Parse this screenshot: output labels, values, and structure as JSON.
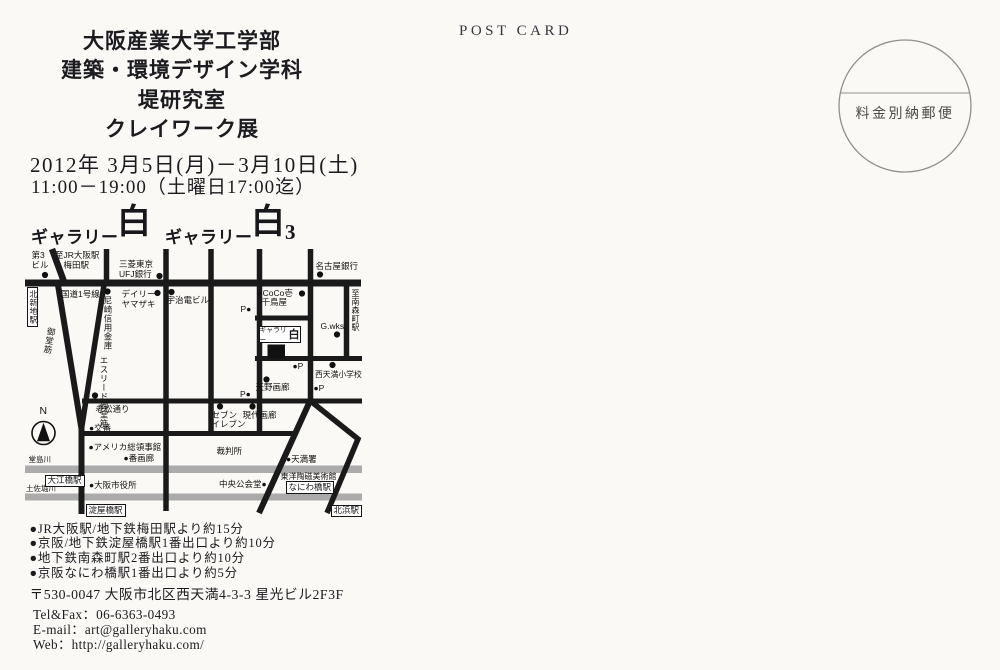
{
  "postcard": {
    "post_card_label": "POST CARD",
    "stamp_text": "料金別納郵便",
    "title_lines": [
      "大阪産業大学工学部",
      "建築・環境デザイン学科",
      "堤研究室",
      "クレイワーク展"
    ],
    "date_line": "2012年 3月5日(月)－3月10日(土)",
    "time_line": "11:00－19:00（土曜日17:00迄）",
    "gallery_line": {
      "prefix1": "ギャラリー",
      "logo1": "白",
      "prefix2": "ギャラリー",
      "logo2": "白",
      "suffix2": "3"
    },
    "access_lines": [
      "●JR大阪駅/地下鉄梅田駅より約15分",
      "●京阪/地下鉄淀屋橋駅1番出口より約10分",
      "●地下鉄南森町駅2番出口より約10分",
      "●京阪なにわ橋駅1番出口より約5分"
    ],
    "address": "〒530-0047 大阪市北区西天満4-3-3 星光ビル2F3F",
    "tel": "Tel&Fax：06-6363-0493",
    "email": "E-mail：art@galleryhaku.com",
    "web": "Web：http://galleryhaku.com/"
  },
  "map": {
    "gallery_box": {
      "prefix": "ギャラリー",
      "logo": "白"
    },
    "labels": [
      {
        "t": "N",
        "x": 39.5,
        "y": 406,
        "s": 10.5
      },
      {
        "t": "第3\nビル",
        "x": 31.5,
        "y": 251,
        "pre": 1
      },
      {
        "t": "至JR大阪駅\n　梅田駅",
        "x": 55,
        "y": 251,
        "pre": 1
      },
      {
        "t": "三菱東京\nUFJ銀行",
        "x": 119,
        "y": 260,
        "pre": 1
      },
      {
        "t": "名古屋銀行",
        "x": 315.5,
        "y": 261.5
      },
      {
        "t": "北新地駅",
        "x": 26.5,
        "y": 286.5,
        "v": 1,
        "box": 1,
        "s": 8
      },
      {
        "t": "国道1号線",
        "x": 61,
        "y": 289.5
      },
      {
        "t": "尼崎信用金庫",
        "x": 102.5,
        "y": 295.5,
        "v": 1
      },
      {
        "t": "デイリー\nヤマザキ",
        "x": 121.5,
        "y": 290,
        "pre": 1
      },
      {
        "t": "宇治電ビル",
        "x": 166.5,
        "y": 295.5
      },
      {
        "t": "●CoCo壱",
        "x": 257.5,
        "y": 288.5
      },
      {
        "t": "千鳥屋",
        "x": 261.5,
        "y": 297.5
      },
      {
        "t": "至南森町駅",
        "x": 350,
        "y": 288.5,
        "v": 1,
        "s": 8
      },
      {
        "t": "G.wks.",
        "x": 320.5,
        "y": 321.5
      },
      {
        "t": "P●",
        "x": 240.5,
        "y": 304.5
      },
      {
        "t": "●P",
        "x": 292.5,
        "y": 361.5
      },
      {
        "t": "西天満小学校",
        "x": 315,
        "y": 370.5,
        "s": 7.8
      },
      {
        "t": "●P",
        "x": 313.5,
        "y": 383.5
      },
      {
        "t": "天野画廊",
        "x": 255.5,
        "y": 383
      },
      {
        "t": "P●",
        "x": 240,
        "y": 389.5
      },
      {
        "t": "セブン\nイレブン",
        "x": 211.5,
        "y": 410.5,
        "pre": 1
      },
      {
        "t": "現代画廊",
        "x": 242.5,
        "y": 410.5
      },
      {
        "t": "御堂筋",
        "x": 44,
        "y": 327,
        "v": 1,
        "r": 10
      },
      {
        "t": "エスリード御堂筋",
        "x": 98.5,
        "y": 356,
        "v": 1,
        "h": 47
      },
      {
        "t": "老松通り",
        "x": 95.5,
        "y": 404.5
      },
      {
        "t": "●交番",
        "x": 89,
        "y": 423.5
      },
      {
        "t": "●アメリカ総領事館",
        "x": 88.5,
        "y": 442.5
      },
      {
        "t": "●番画廊",
        "x": 123.5,
        "y": 454
      },
      {
        "t": "裁判所",
        "x": 216.5,
        "y": 446.5
      },
      {
        "t": "●天満署",
        "x": 286,
        "y": 455
      },
      {
        "t": "堂島川",
        "x": 28.5,
        "y": 456,
        "s": 7.5
      },
      {
        "t": "土佐堀川",
        "x": 26,
        "y": 485,
        "s": 7.5
      },
      {
        "t": "大江橋駅",
        "x": 44.5,
        "y": 474.5,
        "box": 1
      },
      {
        "t": "●大阪市役所",
        "x": 89,
        "y": 480.5
      },
      {
        "t": "中央公会堂●",
        "x": 219,
        "y": 480
      },
      {
        "t": "東洋陶磁美術館",
        "x": 280.5,
        "y": 472.5,
        "s": 8
      },
      {
        "t": "なにわ橋駅",
        "x": 285.5,
        "y": 481,
        "box": 1
      },
      {
        "t": "淀屋橋駅",
        "x": 85.5,
        "y": 504,
        "box": 1
      },
      {
        "t": "北浜駅",
        "x": 330.5,
        "y": 504.5,
        "box": 1
      }
    ],
    "dots": [
      [
        45,
        275
      ],
      [
        159.5,
        276
      ],
      [
        320,
        274.5
      ],
      [
        107.5,
        291.5
      ],
      [
        157.5,
        293
      ],
      [
        171.5,
        292
      ],
      [
        302,
        293.5
      ],
      [
        337,
        334.5
      ],
      [
        332.5,
        365
      ],
      [
        266.5,
        379.5
      ],
      [
        220,
        406.5
      ],
      [
        252.5,
        406.5
      ],
      [
        95,
        395.5
      ]
    ]
  }
}
